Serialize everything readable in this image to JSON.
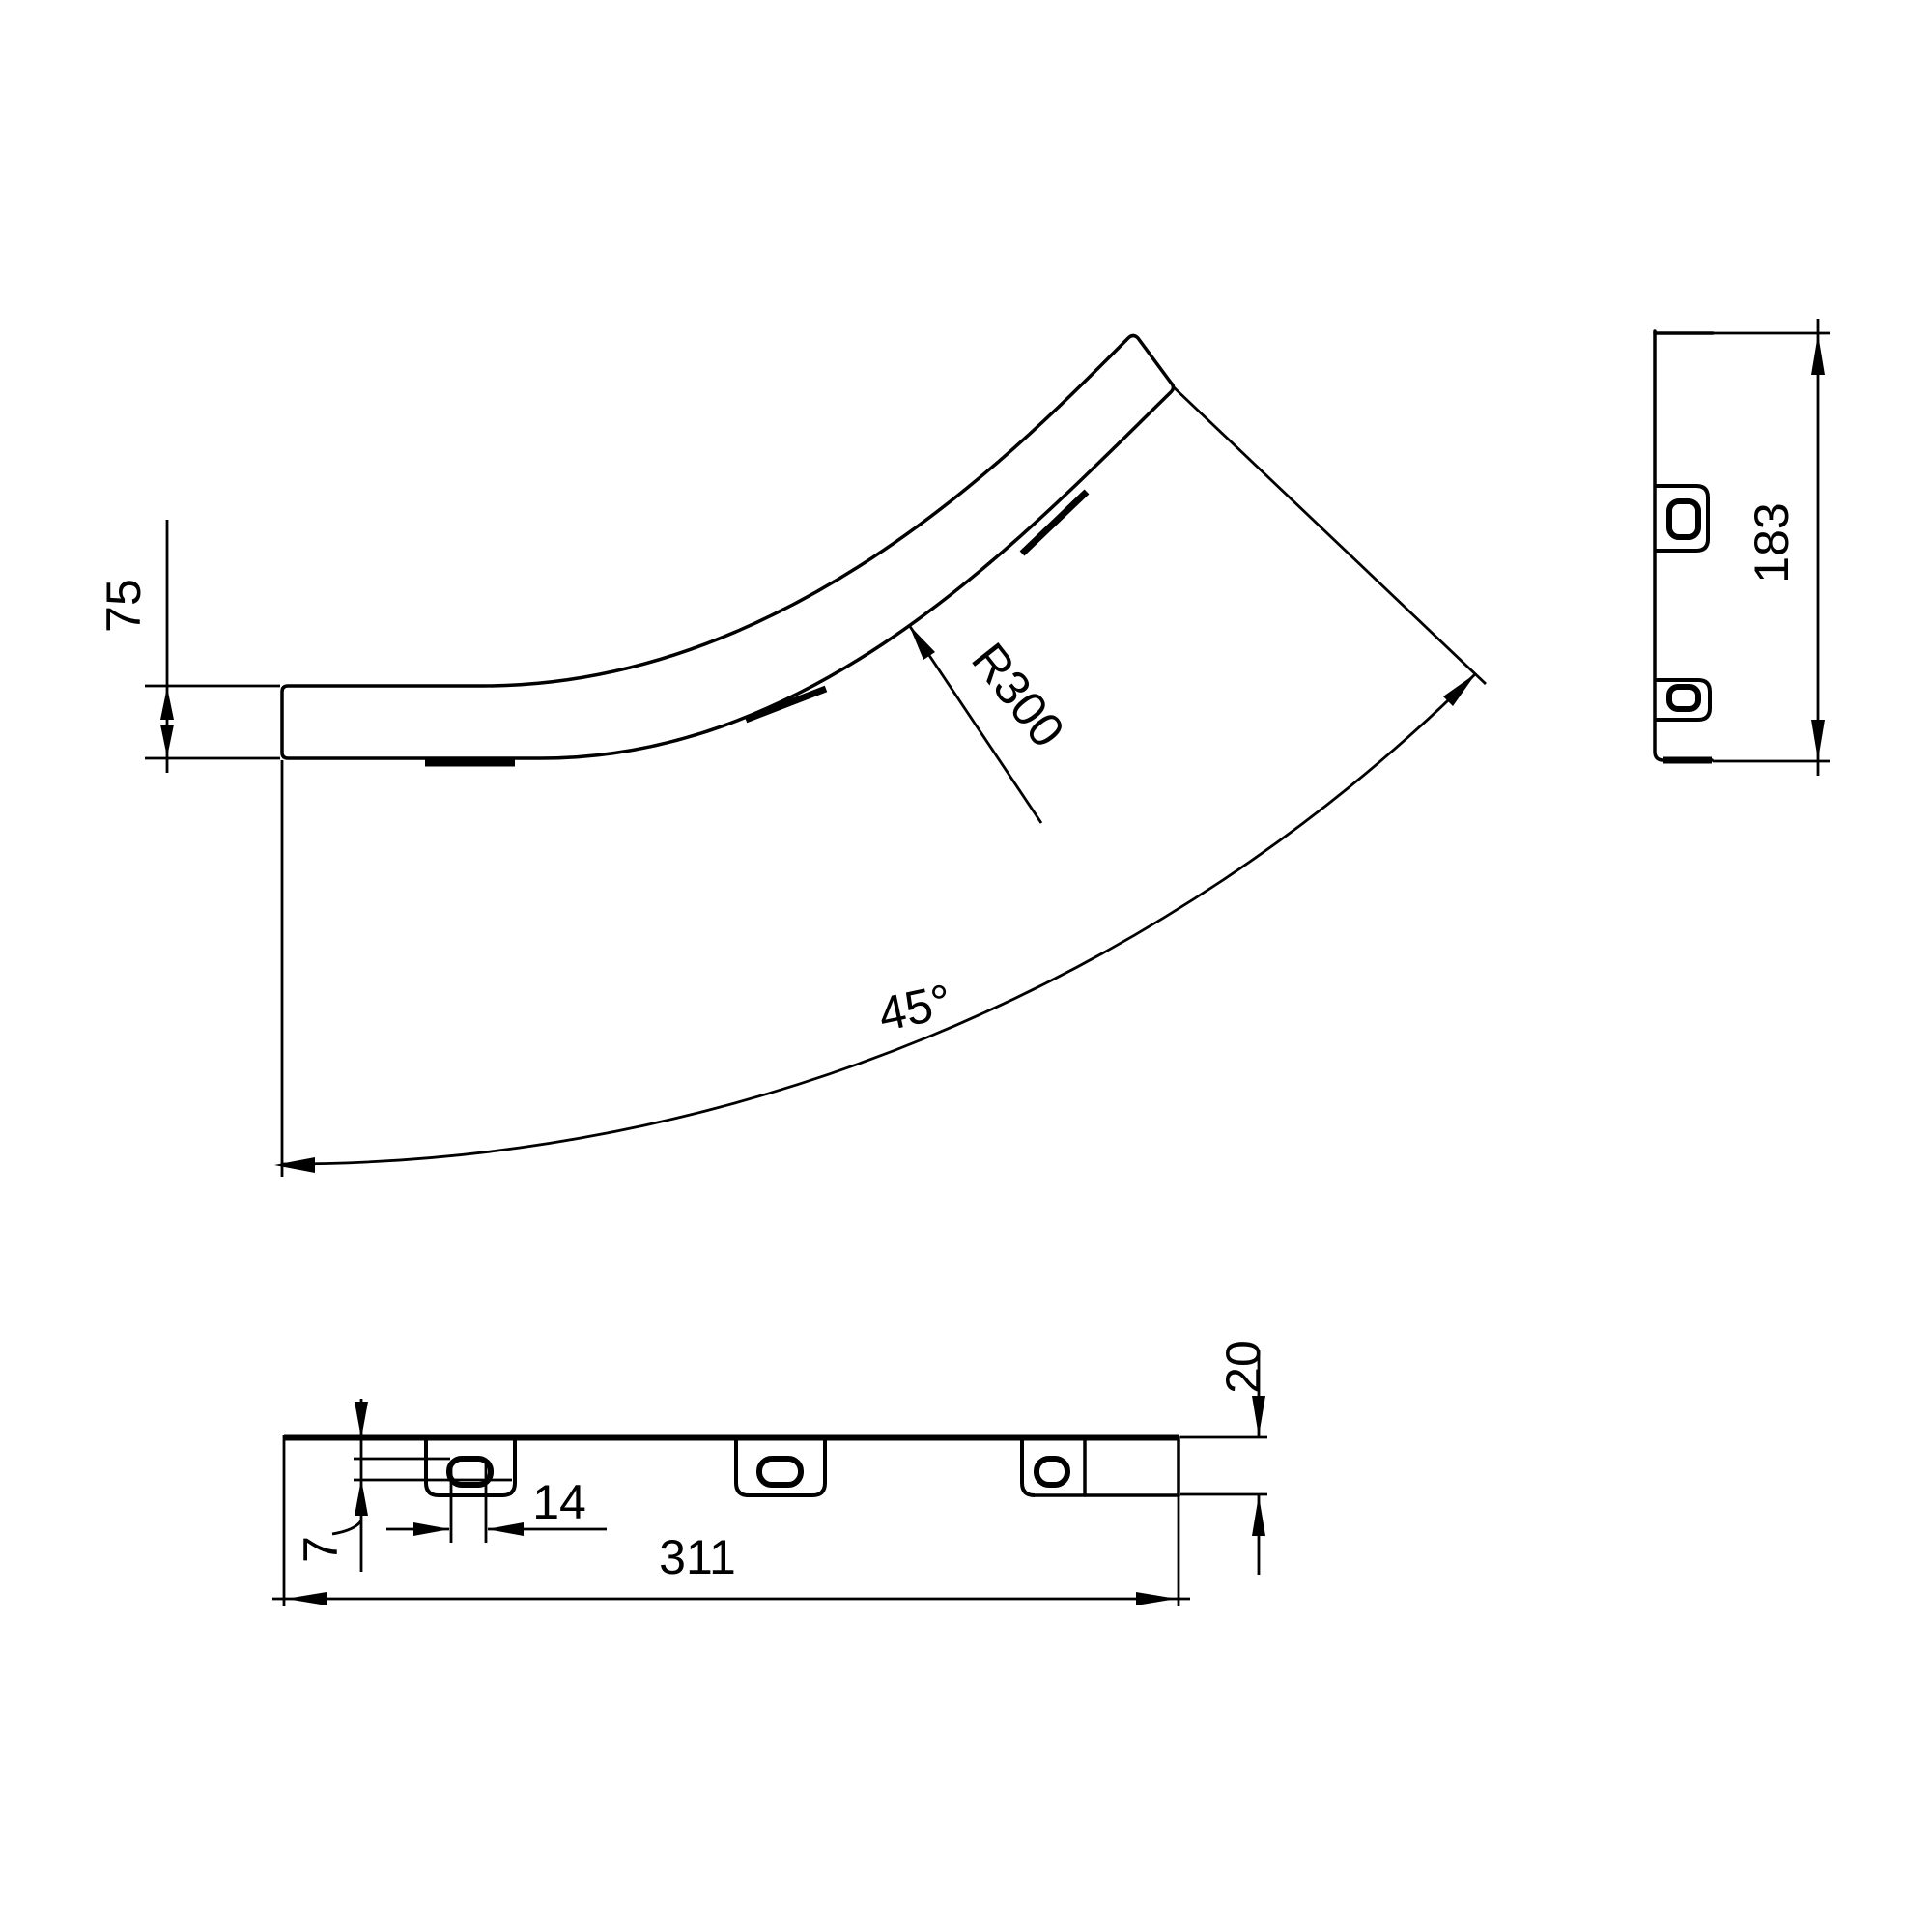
{
  "drawing": {
    "type": "technical-drawing",
    "background_color": "#ffffff",
    "line_color": "#000000",
    "views": {
      "main_view": {
        "description": "plan view of 45 degree bend cover",
        "width_label": "75",
        "radius_label": "R300",
        "angle_label": "45°"
      },
      "side_view": {
        "description": "end elevation with two slotted tabs",
        "height_label": "183"
      },
      "bottom_view": {
        "description": "flange elevation with three slotted tabs",
        "length_label": "311",
        "slot_width_label": "14",
        "slot_offset_label": "7",
        "flange_height_label": "20"
      }
    }
  }
}
